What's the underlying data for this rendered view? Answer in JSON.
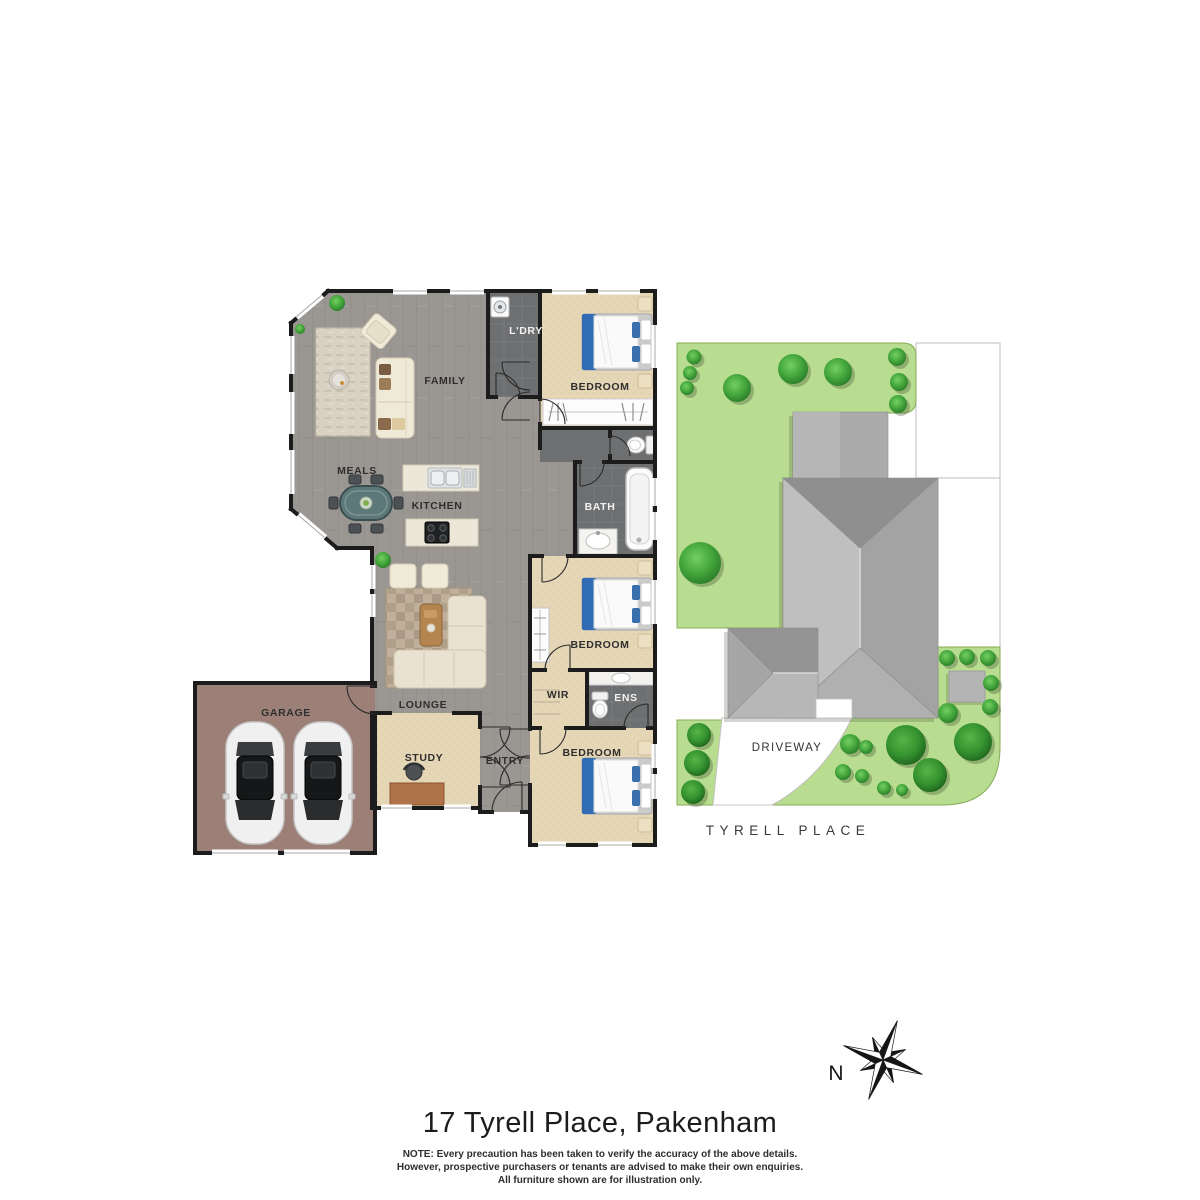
{
  "title": "17 Tyrell Place, Pakenham",
  "note": {
    "line1": "NOTE: Every precaution has been taken to verify the accuracy of the above details.",
    "line2": "However, prospective purchasers or tenants are advised to make their own enquiries.",
    "line3": "All furniture shown are for illustration only."
  },
  "compass": {
    "north_label": "N"
  },
  "floorplan": {
    "rooms": {
      "family": "FAMILY",
      "meals": "MEALS",
      "kitchen": "KITCHEN",
      "laundry": "L'DRY",
      "bedroom_top": "BEDROOM",
      "bath": "BATH",
      "bedroom_mid": "BEDROOM",
      "wir": "WIR",
      "ens": "ENS",
      "bedroom_bottom": "BEDROOM",
      "lounge": "LOUNGE",
      "study": "STUDY",
      "entry": "ENTRY",
      "garage": "GARAGE"
    }
  },
  "siteplan": {
    "driveway": "DRIVEWAY",
    "street": "TYRELL PLACE"
  },
  "colors": {
    "wood_floor": "#9a9792",
    "carpet": "#e5d6b6",
    "tile": "#6d6f71",
    "garage_floor": "#9c8077",
    "wall": "#1c1c1c",
    "lawn": "#b9dd90",
    "tree_green": "#43a83e",
    "roof_gray": "#a3a3a3",
    "accent_blue": "#2f6cb3"
  }
}
